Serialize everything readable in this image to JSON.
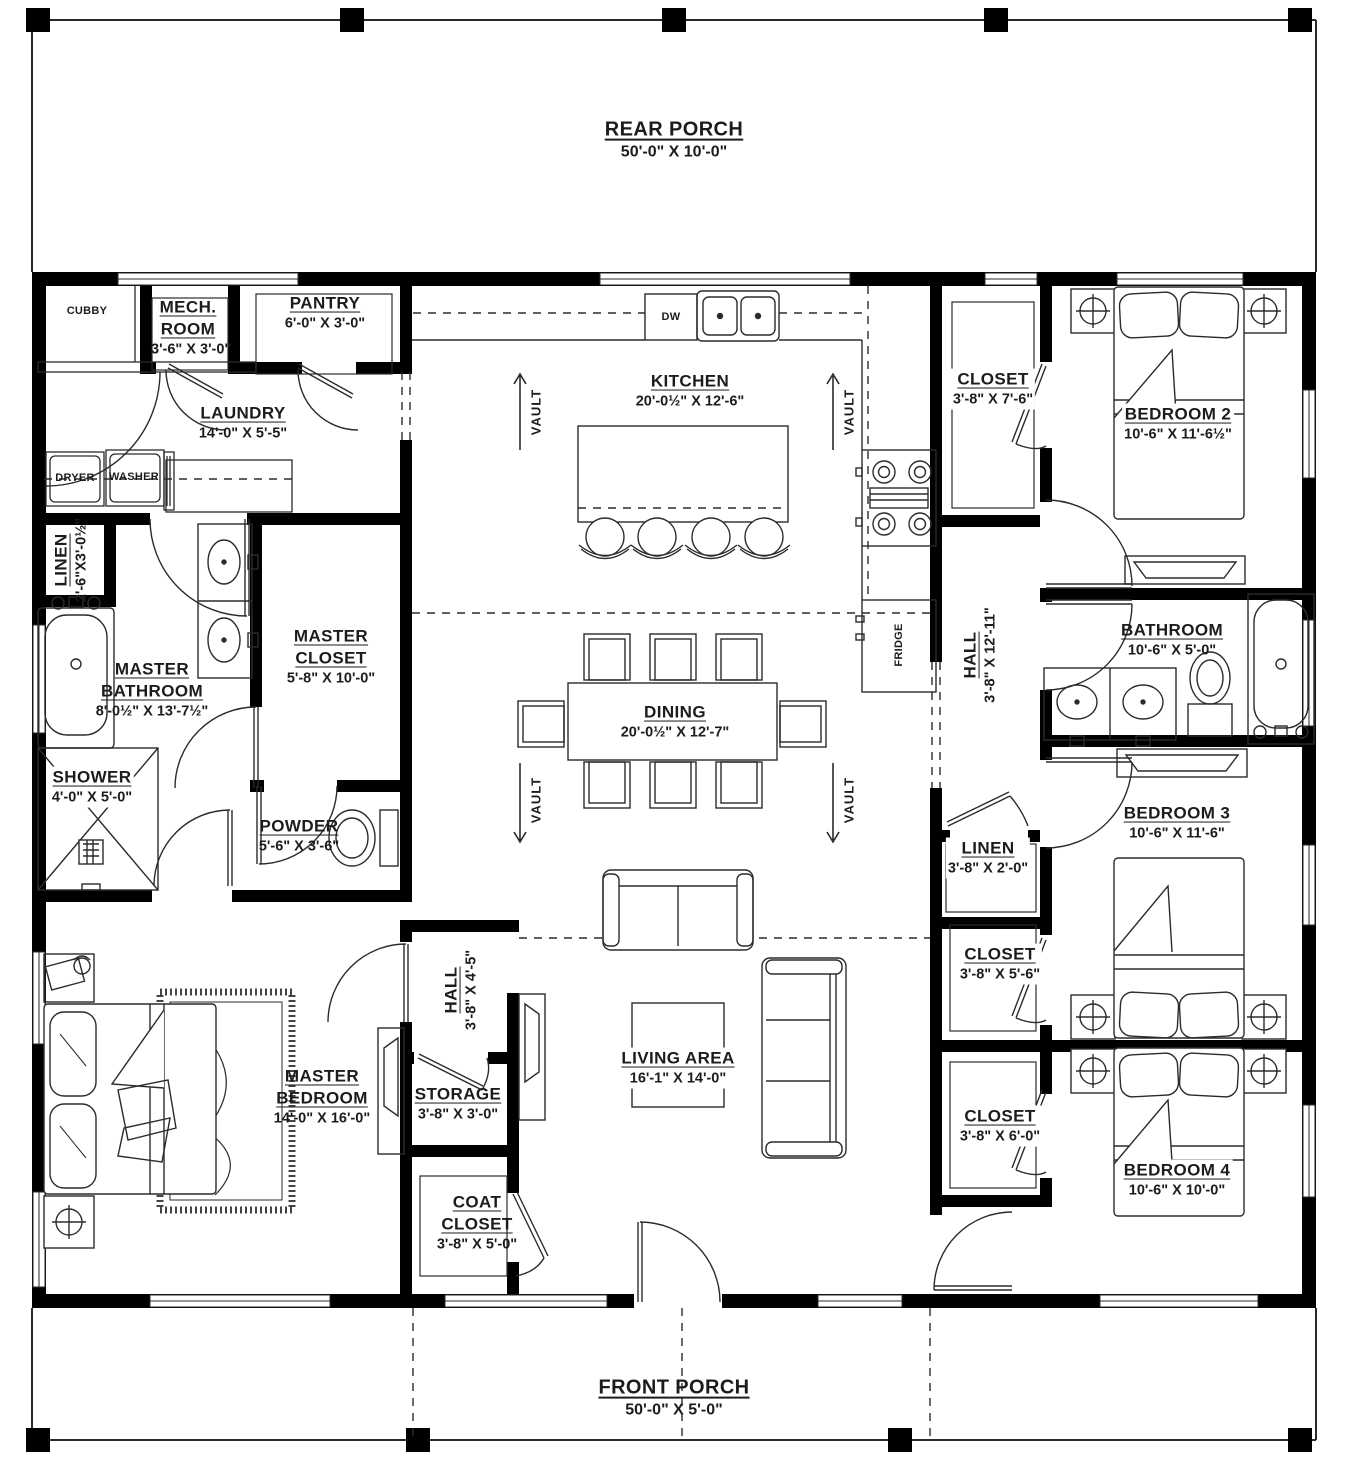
{
  "rooms": {
    "rear_porch": {
      "name": "REAR PORCH",
      "dims": "50'-0\" X 10'-0\""
    },
    "front_porch": {
      "name": "FRONT PORCH",
      "dims": "50'-0\" X 5'-0\""
    },
    "cubby": {
      "name": "CUBBY",
      "dims": ""
    },
    "mech_room": {
      "name": "MECH. ROOM",
      "dims": "3'-6\" X 3'-0\""
    },
    "pantry": {
      "name": "PANTRY",
      "dims": "6'-0\" X 3'-0\""
    },
    "laundry": {
      "name": "LAUNDRY",
      "dims": "14'-0\" X 5'-5\""
    },
    "kitchen": {
      "name": "KITCHEN",
      "dims": "20'-0½\" X 12'-6\""
    },
    "closet_bedroom2": {
      "name": "CLOSET",
      "dims": "3'-8\" X 7'-6\""
    },
    "bedroom2": {
      "name": "BEDROOM 2",
      "dims": "10'-6\" X 11'-6½\""
    },
    "linen_left": {
      "name": "LINEN",
      "dims": "2'-6\"X3'-0½\""
    },
    "master_closet": {
      "name": "MASTER CLOSET",
      "dims": "5'-8\" X 10'-0\""
    },
    "master_bathroom": {
      "name": "MASTER BATHROOM",
      "dims": "8'-0½\" X 13'-7½\""
    },
    "hall_right": {
      "name": "HALL",
      "dims": "3'-8\" X 12'-11\""
    },
    "bathroom": {
      "name": "BATHROOM",
      "dims": "10'-6\" X 5'-0\""
    },
    "shower": {
      "name": "SHOWER",
      "dims": "4'-0\" X 5'-0\""
    },
    "powder": {
      "name": "POWDER",
      "dims": "5'-6\" X 3'-6\""
    },
    "dining": {
      "name": "DINING",
      "dims": "20'-0½\" X 12'-7\""
    },
    "bedroom3": {
      "name": "BEDROOM 3",
      "dims": "10'-6\" X 11'-6\""
    },
    "linen_right": {
      "name": "LINEN",
      "dims": "3'-8\" X 2'-0\""
    },
    "closet_bedroom3": {
      "name": "CLOSET",
      "dims": "3'-8\" X 5'-6\""
    },
    "master_bedroom": {
      "name": "MASTER BEDROOM",
      "dims": "14'-0\" X 16'-0\""
    },
    "hall_center": {
      "name": "HALL",
      "dims": "3'-8\" X 4'-5\""
    },
    "storage": {
      "name": "STORAGE",
      "dims": "3'-8\" X 3'-0\""
    },
    "living_area": {
      "name": "LIVING AREA",
      "dims": "16'-1\" X 14'-0\""
    },
    "closet_bedroom4": {
      "name": "CLOSET",
      "dims": "3'-8\" X 6'-0\""
    },
    "bedroom4": {
      "name": "BEDROOM 4",
      "dims": "10'-6\" X 10'-0\""
    },
    "coat_closet": {
      "name": "COAT CLOSET",
      "dims": "3'-8\" X 5'-0\""
    }
  },
  "appliances": {
    "dishwasher": "DW",
    "dryer": "DRYER",
    "washer": "WASHER",
    "fridge": "FRIDGE"
  },
  "annotations": {
    "vault": "VAULT"
  },
  "colors": {
    "wall": "#000000",
    "line": "#2b2b2b",
    "text": "#1c1c1c",
    "background": "#ffffff"
  }
}
